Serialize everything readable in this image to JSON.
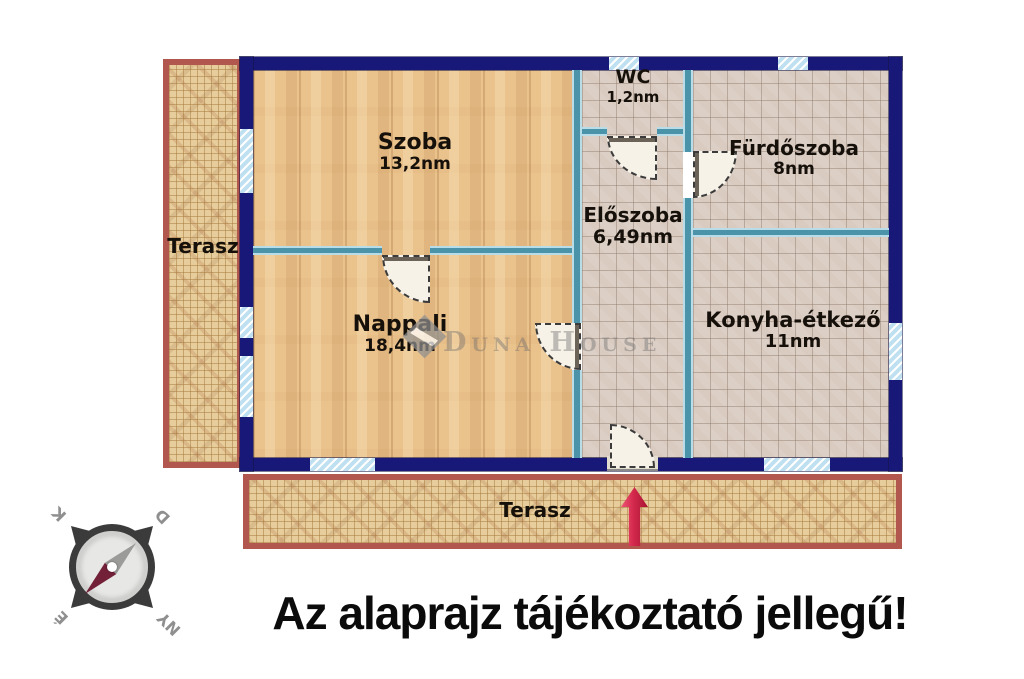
{
  "caption": "Az alaprajz tájékoztató jellegű!",
  "watermark": "Duna House",
  "rooms": {
    "szoba": {
      "name": "Szoba",
      "area": "13,2nm"
    },
    "wc": {
      "name": "WC",
      "area": "1,2nm"
    },
    "furdoszoba": {
      "name": "Fürdőszoba",
      "area": "8nm"
    },
    "eloszoba": {
      "name": "Előszoba",
      "area": "6,49nm"
    },
    "nappali": {
      "name": "Nappali",
      "area": "18,4nm"
    },
    "konyha": {
      "name": "Konyha-étkező",
      "area": "11nm"
    }
  },
  "terraces": {
    "left": "Terasz",
    "bottom": "Terasz"
  },
  "compass": {
    "north": "É",
    "south": "D",
    "east": "K",
    "west": "NY"
  },
  "colors": {
    "wall": "#181878",
    "partition": "#4a93a8",
    "terrace_border": "#b2574d",
    "arrow": "#c41e3c"
  }
}
